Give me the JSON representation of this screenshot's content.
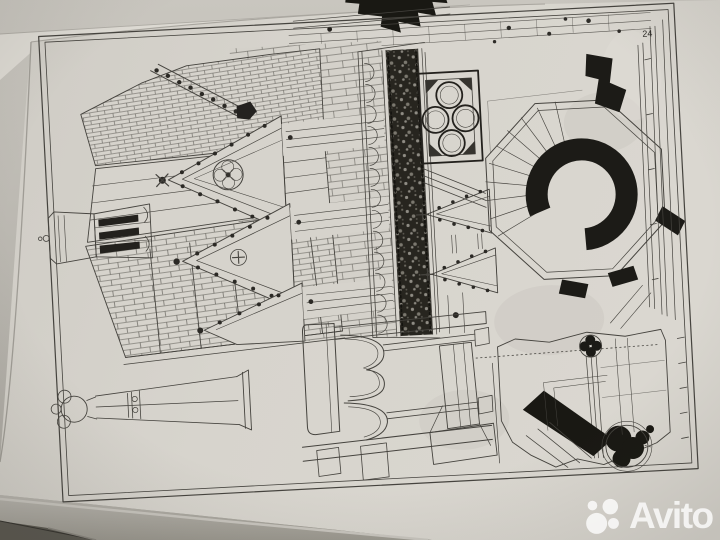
{
  "watermark": {
    "label": "Avito"
  },
  "plate": {
    "number": "24",
    "drawings": [
      "tiled-roof-perspective",
      "roof-dormer-with-louvers",
      "gothic-gables-with-crockets-and-quatrefoils",
      "ornamental-foliage-frieze-band",
      "quatrefoil-tracery-panel",
      "octagonal-stair-tower-plan",
      "horizontal-finial-pinnacle",
      "cusped-arcade-detail",
      "pier-plan-fragment-with-black-poche",
      "cut-off-dark-detail-top"
    ]
  },
  "colors": {
    "paper": "#d6d3cc",
    "paper_light": "#dedbd4",
    "paper_dark": "#c7c4bd",
    "ink": "#45433e",
    "ink_dark": "#23211d",
    "black_fill": "#1b1a16",
    "backdrop_top": "#c9c6bf",
    "backdrop_bottom": "#a49f98",
    "under_page": "#5a574f",
    "watermark": "rgba(255,255,255,0.78)"
  }
}
